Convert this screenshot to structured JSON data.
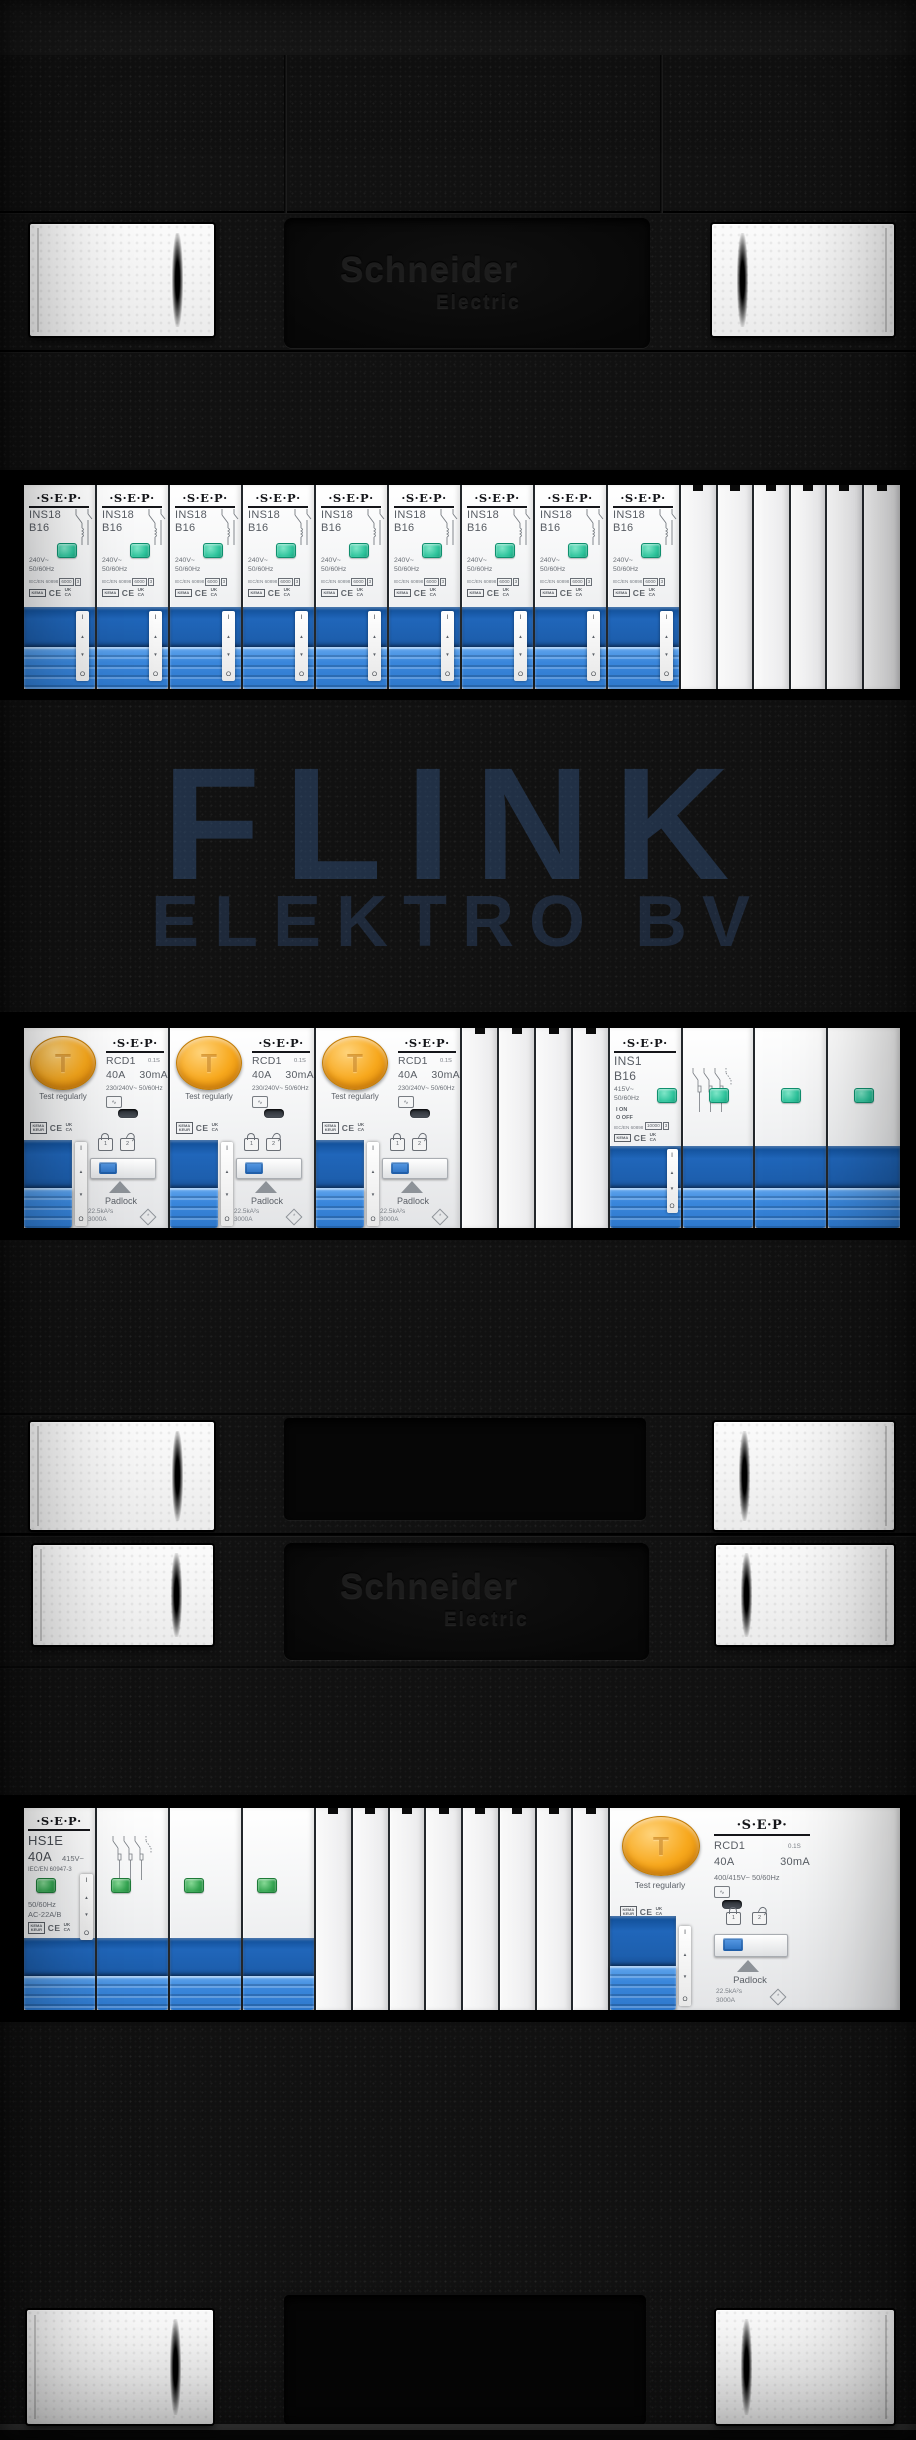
{
  "brand": {
    "name": "Schneider",
    "sub": "Electric"
  },
  "watermark": {
    "line1": "FLINK",
    "line2": "ELEKTRO BV"
  },
  "colors": {
    "enclosure": "#111111",
    "switch_blue": "#3a87dc",
    "switch_blue_dark": "#1d5fae",
    "indicator_teal": "#2fc49c",
    "indicator_green": "#35a552",
    "test_button_orange": "#f7a81d",
    "watermark_blue": "#3a5e94"
  },
  "panel": {
    "row1": {
      "breaker_count": 9,
      "blank_count": 6
    },
    "row2": {
      "rcd_count": 3,
      "blank_count": 4,
      "ins1_poles": 4
    },
    "row3": {
      "hs1e_poles": 4,
      "blank_count": 8,
      "rcd4_poles": 4
    }
  },
  "components": {
    "logo": "·S·E·P·",
    "ins18": {
      "model": "INS18",
      "rating": "B16",
      "voltage": "240V~",
      "frequency": "50/60Hz",
      "standard": "IEC/EN 60898",
      "icn": "6000",
      "energy_class": "3",
      "kema": "KEMA",
      "ce": "CE",
      "uk": "UK",
      "ca": "CA",
      "on": "I",
      "off": "O"
    },
    "rcd2": {
      "model": "RCD1",
      "delay": "0.1S",
      "rated": "40A",
      "residual": "30mA",
      "voltage": "230/240V~",
      "frequency": "50/60Hz",
      "button_glyph": "T",
      "test": "Test regularly",
      "padlock": "Padlock",
      "lock_on": "1",
      "lock_off": "2",
      "let_through": "22.5kA²s",
      "conditional": "3000A",
      "kema1": "KEMA",
      "kema2": "KEUR",
      "ce": "CE",
      "uk": "UK",
      "ca": "CA",
      "on": "I",
      "off": "O"
    },
    "ins1": {
      "model": "INS1",
      "rating": "B16",
      "voltage": "415V~",
      "frequency": "50/60Hz",
      "on_label": "I ON",
      "off_label": "O OFF",
      "icn": "10000",
      "energy_class": "3",
      "standard": "IEC/EN 60898",
      "kema": "KEMA",
      "ce": "CE",
      "uk": "UK",
      "ca": "CA",
      "on": "I",
      "off": "O"
    },
    "hs1e": {
      "model": "HS1E",
      "rated": "40A",
      "voltage": "415V~",
      "standard": "IEC/EN 60947-3",
      "frequency": "50/60Hz",
      "utilization": "AC-22A/B",
      "kema1": "KEMA",
      "kema2": "KEUR",
      "ce": "CE",
      "uk": "UK",
      "ca": "CA",
      "on": "I",
      "off": "O"
    },
    "rcd4": {
      "model": "RCD1",
      "delay": "0.1S",
      "rated": "40A",
      "residual": "30mA",
      "voltage": "400/415V~",
      "frequency": "50/60Hz",
      "button_glyph": "T",
      "test": "Test regularly",
      "padlock": "Padlock",
      "lock_on": "1",
      "lock_off": "2",
      "let_through": "22.5kA²s",
      "conditional": "3000A",
      "kema1": "KEMA",
      "kema2": "KEUR",
      "ce": "CE",
      "uk": "UK",
      "ca": "CA",
      "on": "I",
      "off": "O"
    }
  }
}
